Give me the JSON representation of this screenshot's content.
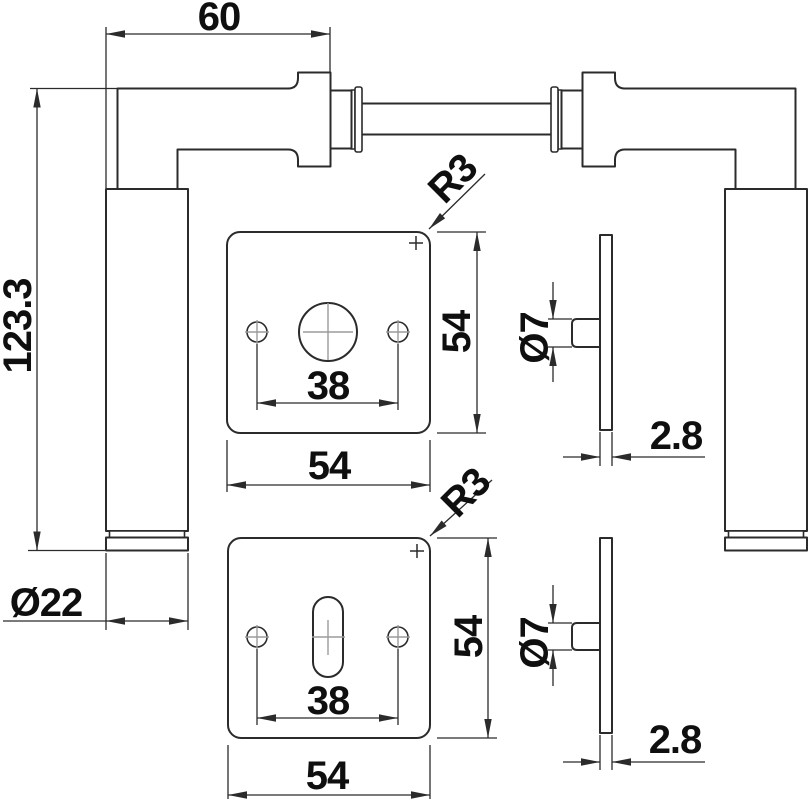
{
  "title": "door-handle-rosette-technical-drawing",
  "colors": {
    "background": "#ffffff",
    "line": "#2b2b2b",
    "text": "#0f0f0f",
    "crosshair": "#9b9b9b"
  },
  "views": {
    "handle_front": {
      "width_label": "60",
      "height_label": "123.3",
      "grip_diameter_label": "Ø22"
    },
    "rosette_plain": {
      "screw_spacing_label": "38",
      "width_label": "54",
      "height_label": "54",
      "corner_radius_label": "R3"
    },
    "rosette_key": {
      "screw_spacing_label": "38",
      "width_label": "54",
      "height_label": "54",
      "corner_radius_label": "R3"
    },
    "rosette_side_top": {
      "pin_diameter_label": "Ø7",
      "thickness_label": "2.8"
    },
    "rosette_side_bottom": {
      "pin_diameter_label": "Ø7",
      "thickness_label": "2.8"
    }
  }
}
